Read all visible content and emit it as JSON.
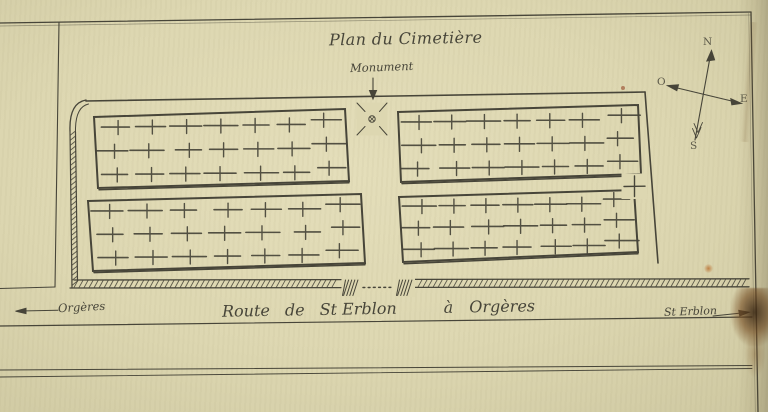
{
  "title": "Plan du Cimetière",
  "labels": {
    "monument": "Monument",
    "road": {
      "parts": [
        "Route",
        "de",
        "St Erblon",
        "à",
        "Orgères"
      ]
    },
    "left_destination": "Orgères",
    "right_destination": "St Erblon"
  },
  "compass": {
    "north": "N",
    "west": "O",
    "east": "E",
    "south": "S"
  },
  "plan": {
    "grave_blocks": [
      {
        "id": "top-left",
        "rows": 3,
        "cols": 7,
        "symbol": "cross"
      },
      {
        "id": "top-right",
        "rows": 3,
        "cols": 7,
        "symbol": "cross"
      },
      {
        "id": "bottom-left",
        "rows": 3,
        "cols": 7,
        "symbol": "cross"
      },
      {
        "id": "bottom-right",
        "rows": 3,
        "cols": 7,
        "symbol": "cross"
      }
    ],
    "features": [
      {
        "id": "monument"
      },
      {
        "id": "entrance-gate"
      },
      {
        "id": "side-square-with-cross"
      }
    ],
    "hatched_walls": [
      "left",
      "bottom"
    ]
  },
  "colors": {
    "paper": "#ddd7b1",
    "ink": "#474539",
    "stain": "#7a4e22"
  }
}
